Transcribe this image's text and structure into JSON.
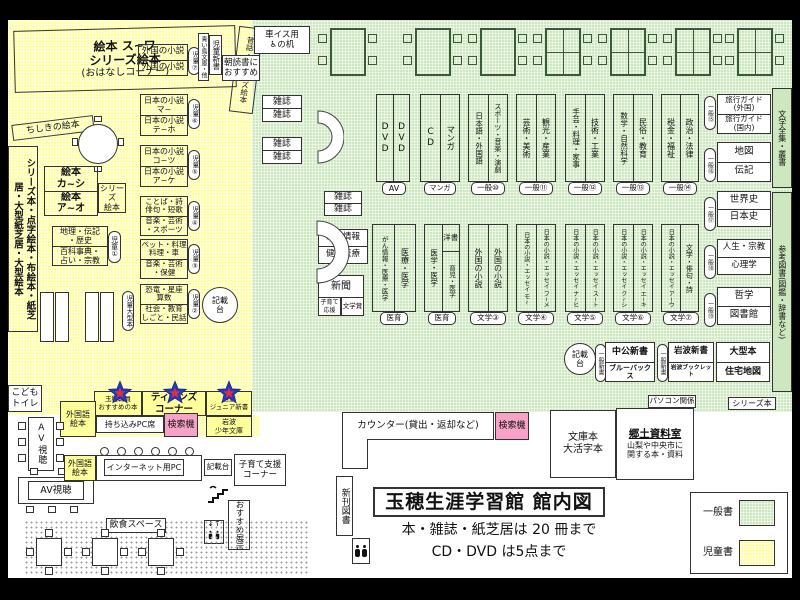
{
  "info": {
    "title": "玉穂生涯学習館 館内図",
    "rule_books": "本・雑誌・紙芝居は 20 冊まで",
    "rule_av": "CD・DVD は5点まで"
  },
  "legend": {
    "general": "一般書",
    "children": "児童書"
  },
  "kids": {
    "ohanashi_main": "絵本 ス~ワ\nシリーズ絵本",
    "ohanashi_sub": "(おはなしコーナー)",
    "mukashi_band": "昔話・シリーズ絵本",
    "chishiki_band": "ちしきの絵本",
    "left_strip": "シリーズ本・点字絵本・布絵本・紙芝居・大型紙芝居・大型絵本",
    "ehon_top": "絵本\nカ~シ",
    "ehon_bot": "絵本\nア~オ",
    "series_small": "シリーズ\n絵本",
    "ref_top": "地理・伝記\n・歴史",
    "ref_bot": "百科事典・\n占い・宗教",
    "caps": {
      "c1": "児童①",
      "c2": "児童②",
      "c3": "児童③",
      "c4": "児童④",
      "c5": "児童⑤",
      "c6": "児童⑥",
      "c7": "児童⑦"
    },
    "ogata_cap": "児童大型本",
    "foreign_top": "外国の小説",
    "foreign_bot": "外国の小説",
    "jp6_top": "日本の小説\nマ~",
    "jp6_bot": "日本の小説\nテ~ホ",
    "jp5_top": "日本の小説\nコ~ツ",
    "jp5_bot": "日本の小説\nア~ケ",
    "jp4_top": "ことば・詩\n俳句・短歌",
    "jp4_bot": "音楽・芸術\n・スポーツ",
    "jp3_top": "ペット・料理\n料理・車",
    "jp3_bot": "音楽・芸術\n・保健",
    "jp2_top": "恐竜・星座\n算数",
    "jp2_bot": "社会・教育\nしごと・民話",
    "kisaidai": "記載\n台",
    "aoitori": "青い鳥文庫・他",
    "jido_shinsho": "児童新書",
    "asadoku": "朝読書に\nおすすめ",
    "kodomo_toilet": "こども\nトイレ"
  },
  "teens": {
    "staff_pick": "玉穂職員\nおすすめの本",
    "teens_corner": "ティーンズ\nコーナー",
    "iwanami_jr": "岩波\nジュニア新書",
    "iwanami_shonen": "岩波\n少年文庫",
    "byod_pc": "持ち込みPC席",
    "search": "検索機",
    "foreign_ehon": "外国語\n絵本"
  },
  "general": {
    "wheelchair_desk_l1": "車イス用",
    "wheelchair_desk_l2": "の机",
    "wheelchair_symbol": "♿",
    "zasshi": "雑誌",
    "gan": "がん情報",
    "kenko": "健康医療",
    "shinbun": "新聞",
    "kosodate_ouen": "子育て\n応援",
    "bungakusho": "文学賞",
    "row1": [
      {
        "l": "DVD",
        "r": "DVD",
        "tag": "AV"
      },
      {
        "l": "CD",
        "r": "マンガ",
        "tag": "マンガ"
      },
      {
        "l": "日本語・外国語",
        "r": "スポーツ・音楽・演劇",
        "tag": "一般⑩"
      },
      {
        "l": "芸術・美術",
        "r": "観光・産業",
        "tag": "一般⑪"
      },
      {
        "l": "手芸・料理・家事",
        "r": "技術・工業",
        "tag": "一般⑫"
      },
      {
        "l": "数学・自然科学",
        "r": "民俗・教育",
        "tag": "一般⑬"
      },
      {
        "l": "税金・福祉",
        "r": "政治・法律",
        "tag": "一般⑭"
      }
    ],
    "side": [
      {
        "cap": "一般⑮",
        "top": "旅行ガイド\n(外国)",
        "bot": "旅行ガイド\n(国内)"
      },
      {
        "cap": "一般⑯",
        "top": "地図",
        "bot": "伝記"
      },
      {
        "cap": "一般⑰",
        "top": "世界史",
        "bot": "日本史"
      },
      {
        "cap": "一般⑱",
        "top": "人生・宗教",
        "bot": "心理学"
      },
      {
        "cap": "一般⑲",
        "top": "哲学",
        "bot": "図書館"
      }
    ],
    "far1": "文学全集・叢書",
    "far2": "参考図書(図鑑・辞書など)",
    "row2": [
      {
        "l": "がん情報・医療・医学",
        "r": "医療・医学",
        "tag": "医育"
      },
      {
        "l": "医学・医学",
        "rt": "洋書",
        "rb": "育児・医学",
        "tag": "医育"
      },
      {
        "l": "外国の小説",
        "r": "外国の小説",
        "tag": "文学③"
      },
      {
        "l": "日本の小説・エッセイ モ~",
        "r": "日本の小説・エッセイ フ~メ",
        "tag": "文学④"
      },
      {
        "l": "日本の小説・エッセイ ナ~ヒ",
        "r": "日本の小説・エッセイ ス~ト",
        "tag": "文学⑤"
      },
      {
        "l": "日本の小説・エッセイ ク~シ",
        "r": "日本の小説・エッセイ エ~キ",
        "tag": "文学⑥"
      },
      {
        "l": "日本の小説・エッセイ ア~ウ",
        "r": "文学・俳句・詩",
        "tag": "文学⑦"
      }
    ],
    "row3": {
      "kisaidai": "記載\n台",
      "cap_a": "一般新書",
      "chuko": "中公新書",
      "bluebacks": "ブルーバックス",
      "cap_b": "一般新書",
      "iwanami": "岩波新書",
      "booklet": "岩波ブックレット",
      "ogata": "大型本",
      "jutaku": "住宅地図"
    },
    "pasokon": "パソコン関係",
    "series_bon": "シリーズ本"
  },
  "bottom": {
    "counter": "カウンター(貸出・返却など)",
    "search": "検索機",
    "bunko": "文庫本\n大活字本",
    "kyodo_title": "郷土資料室",
    "kyodo_desc": "山梨や中央市に\n関する本・資料",
    "shinkan": "新刊図書",
    "av": "AV視聴",
    "internet_pc": "インターネット用PC",
    "kisaidai": "記載台",
    "kosodate_corner": "子育て支援\nコーナー",
    "osusume_tenji": "おすすめ展示",
    "inshoku": "飲食スペース",
    "elevator_arrows": "↓↑"
  }
}
